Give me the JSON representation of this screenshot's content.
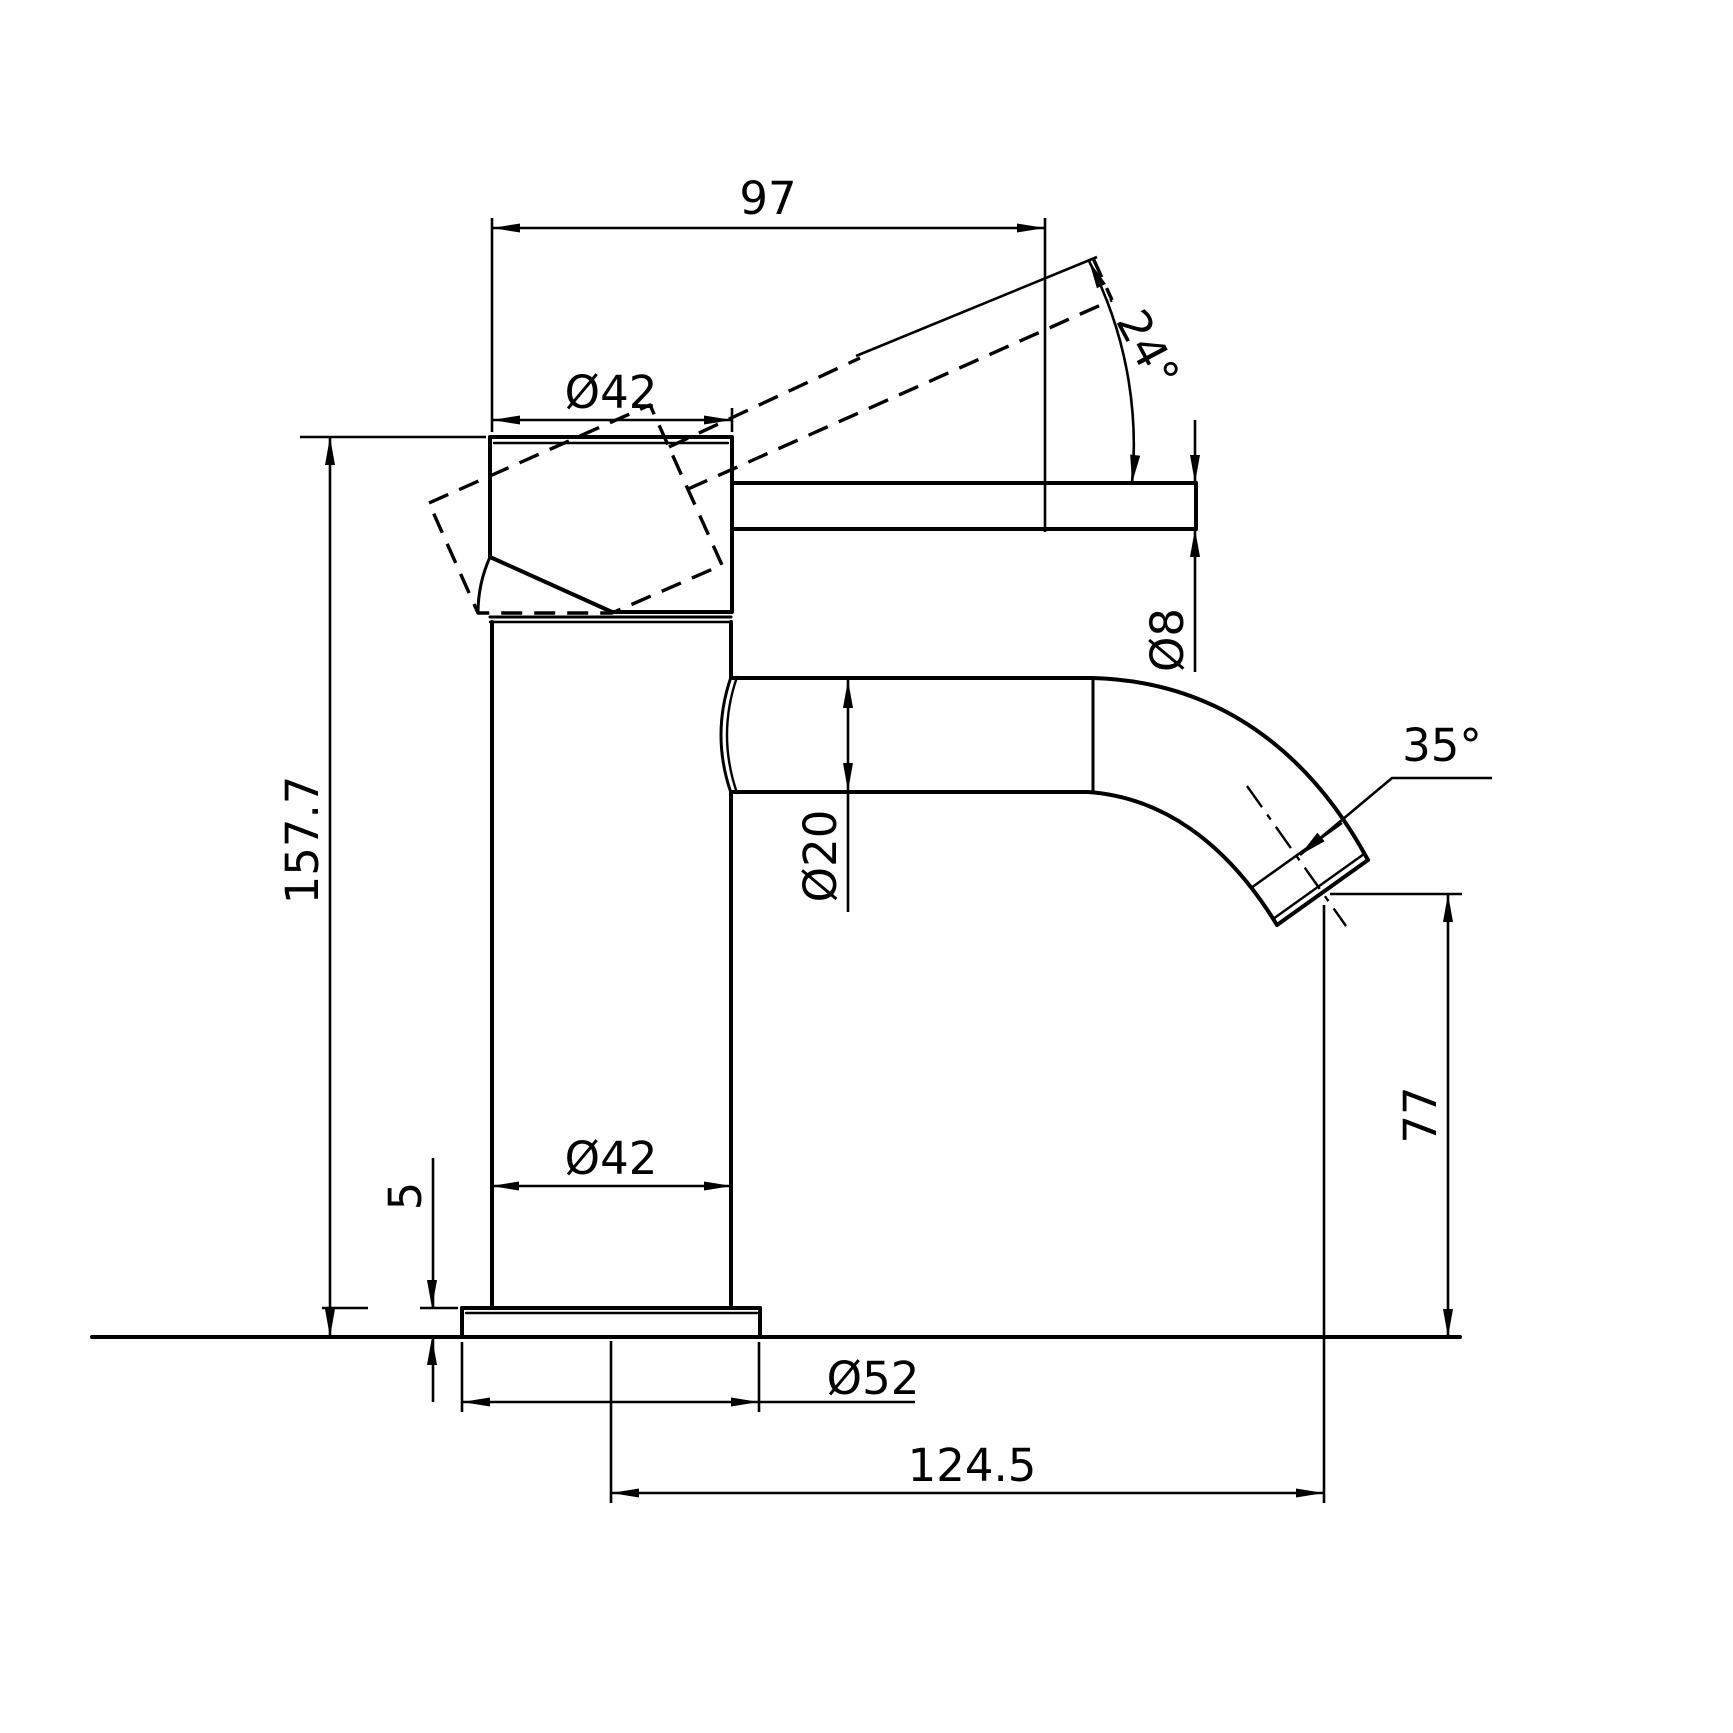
{
  "drawing": {
    "type": "technical-dimension-drawing",
    "subject": "basin mixer tap side elevation",
    "background_color": "#ffffff",
    "line_color": "#000000",
    "labels": {
      "top_width": "97",
      "handle_diameter": "Ø42",
      "handle_tilt_angle": "24°",
      "lever_diameter": "Ø8",
      "total_height": "157.7",
      "spout_tube_diameter": "Ø20",
      "outlet_angle": "35°",
      "outlet_height": "77",
      "base_plate_thickness": "5",
      "body_diameter": "Ø42",
      "base_plate_diameter": "Ø52",
      "spout_reach": "124.5"
    }
  }
}
